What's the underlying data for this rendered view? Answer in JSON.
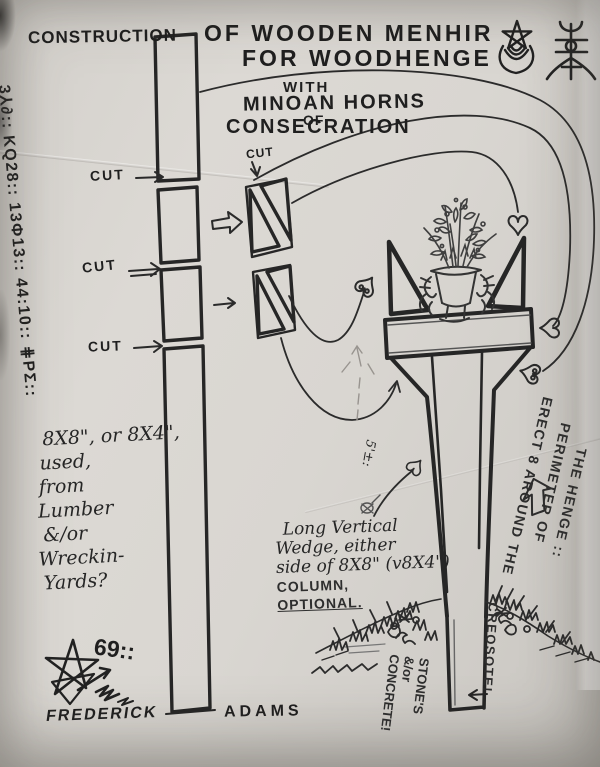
{
  "document": {
    "title_left": "CONSTRUCTION",
    "title_line1": "OF WOODEN MENHIR",
    "title_line2": "FOR WOODHENGE",
    "subtitle_line1": "WITH",
    "subtitle_line2": "MINOAN HORNS",
    "subtitle_line3": "OF",
    "subtitle_line4": "CONSECRATION"
  },
  "margin_glyphs": "3⅄∂:: KQ28:: 13Φ13:: 44:10:: ⋕PΣ::",
  "cut_labels": {
    "joint1": "CUT",
    "joint2": "CUT",
    "joint3": "CUT",
    "wedge_detail": "CUT"
  },
  "notes": {
    "lumber": {
      "line1": "8X8\", or 8X4\",",
      "line2": "used,",
      "line3": "from",
      "line4": "Lumber",
      "line5": "&/or",
      "line6": "Wreckin-",
      "line7": "Yards?"
    },
    "wedge": {
      "line1": "Long Vertical",
      "line2": "Wedge, either",
      "line3": "side of 8X8\" (v8X4\")",
      "line4": "COLUMN,",
      "line5": "OPTIONAL."
    },
    "erect": {
      "line1": "ERECT 8 AROUND THE",
      "line2": "PERIMETER OF",
      "line3": "THE HENGE ::"
    },
    "height_label": "5'±:",
    "foundation": {
      "line1": "STONE'S",
      "line2": "&/or",
      "line3": "CONCRETE!"
    },
    "preservative": "CREOSOTE!"
  },
  "signature": {
    "sigil_glyph": "69::",
    "first_name": "FREDERICK",
    "last_name": "ADAMS"
  },
  "symbols": {
    "top_right_1": "pentagram-crescent-sigil",
    "top_right_2": "tree-glyph-sigil"
  },
  "colors": {
    "paper": "#d8d5d0",
    "paper_edge": "#efeeec",
    "ink": "#232323",
    "pencil": "#8f8c88"
  }
}
